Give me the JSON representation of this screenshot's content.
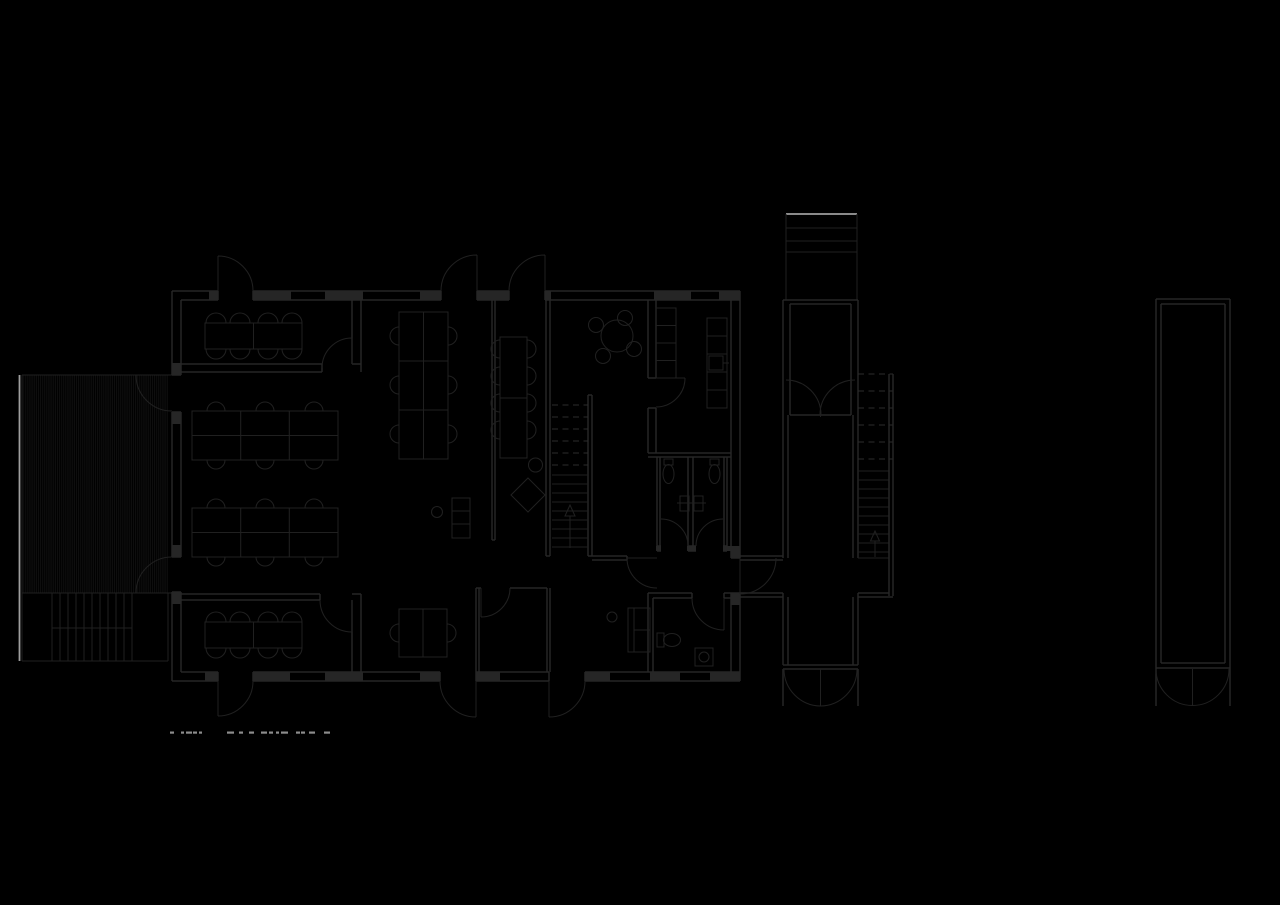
{
  "document": {
    "kind": "architectural floor plan drawing, white-on-black CAD linework",
    "visible_text": ""
  },
  "colors": {
    "background": "#000000",
    "wall_line": "#262626",
    "furniture_line": "#202020",
    "hatch_line": "#151515",
    "overhead_dash": "#2b2b2b",
    "highlight_edge": "#9e9e9e",
    "caption_dash": "#8c8c8c"
  },
  "caption": {
    "y": 731.5,
    "height": 2.2,
    "dash_segments": [
      [
        170,
        4
      ],
      [
        181,
        3
      ],
      [
        186,
        6
      ],
      [
        193,
        4
      ],
      [
        199,
        3
      ],
      [
        227,
        7
      ],
      [
        239,
        4
      ],
      [
        249,
        5
      ],
      [
        261,
        6
      ],
      [
        269,
        4
      ],
      [
        276,
        3
      ],
      [
        281,
        7
      ],
      [
        296,
        4
      ],
      [
        301,
        4
      ],
      [
        309,
        6
      ],
      [
        324,
        6
      ]
    ]
  }
}
